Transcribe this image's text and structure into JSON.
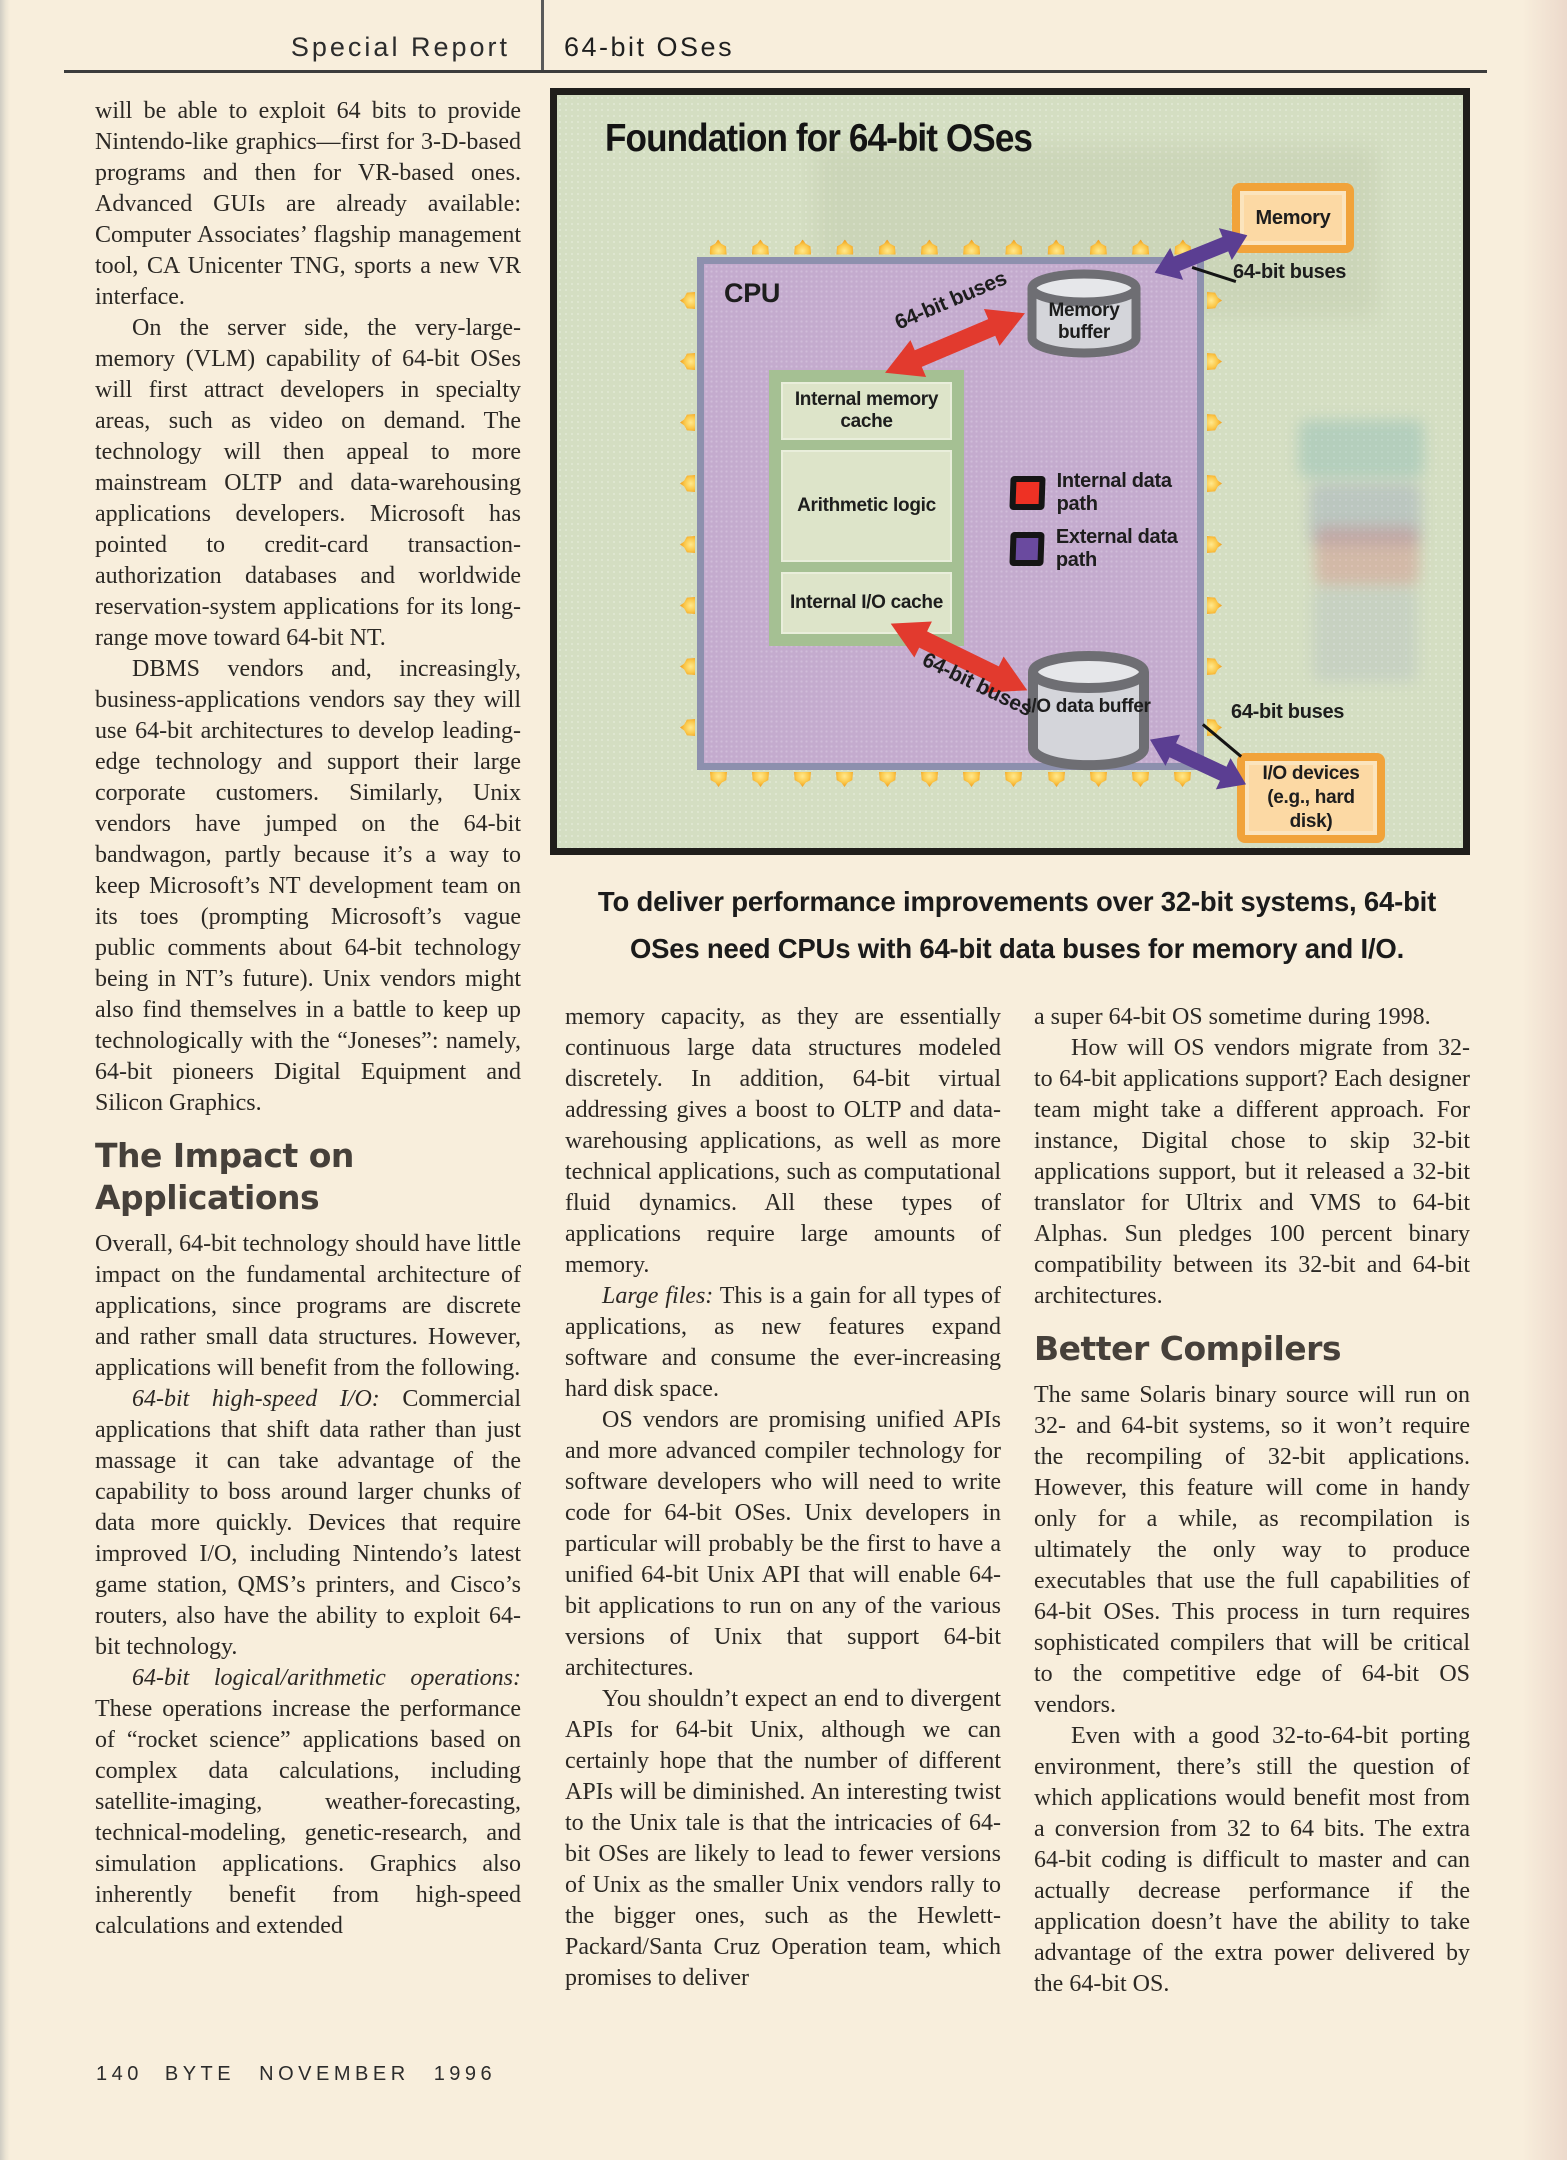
{
  "header": {
    "section": "Special Report",
    "topic": "64-bit OSes"
  },
  "footer": {
    "page_number": "140",
    "magazine_issue": "BYTE NOVEMBER 1996"
  },
  "figure": {
    "title": "Foundation for 64-bit OSes",
    "cpu_label": "CPU",
    "blocks": {
      "internal_memory_cache": "Internal memory cache",
      "arithmetic_logic": "Arithmetic logic",
      "internal_io_cache": "Internal I/O cache",
      "memory_buffer": "Memory buffer",
      "io_data_buffer": "I/O data buffer",
      "memory": "Memory",
      "io_devices": "I/O devices (e.g., hard disk)"
    },
    "bus_label": "64-bit buses",
    "legend": {
      "internal": "Internal data path",
      "external": "External data path"
    },
    "caption": "To deliver performance improvements over 32-bit systems, 64-bit OSes need CPUs with 64-bit data buses for memory and I/O.",
    "colors": {
      "internal_path": "#ee3124",
      "external_path": "#6a4a9f",
      "bus_red": "#e23a2e",
      "bus_purple": "#5b3e92",
      "diagram_bg": "#d4dec2",
      "cpu_fill": "#c4abce",
      "orange_border": "#f1a33a"
    }
  },
  "article": {
    "left": {
      "p1": "will be able to exploit 64 bits to provide Nintendo-like graphics—first for 3-D-based programs and then for VR-based ones. Advanced GUIs are already available: Computer Associates’ flagship management tool, CA Unicenter TNG, sports a new VR interface.",
      "p2": "On the server side, the very-large-memory (VLM) capability of 64-bit OSes will first attract developers in specialty areas, such as video on demand. The technology will then appeal to more mainstream OLTP and data-warehousing applications developers. Microsoft has pointed to credit-card transaction-authorization databases and worldwide reservation-system applications for its long-range move toward 64-bit NT.",
      "p3": "DBMS vendors and, increasingly, business-applications vendors say they will use 64-bit architectures to develop leading-edge technology and support their large corporate customers. Similarly, Unix vendors have jumped on the 64-bit bandwagon, partly because it’s a way to keep Microsoft’s NT development team on its toes (prompting Microsoft’s vague public comments about 64-bit technology being in NT’s future). Unix vendors might also find themselves in a battle to keep up technologically with the “Joneses”: namely, 64-bit pioneers Digital Equipment and Silicon Graphics.",
      "heading": "The Impact on Applications",
      "p4": "Overall, 64-bit technology should have little impact on the fundamental architecture of applications, since programs are discrete and rather small data structures. However, applications will benefit from the following.",
      "p5_lead": "64-bit high-speed I/O:",
      "p5_text": " Commercial applications that shift data rather than just massage it can take advantage of the capability to boss around larger chunks of data more quickly. Devices that require improved I/O, including Nintendo’s latest game station, QMS’s printers, and Cisco’s routers, also have the ability to exploit 64-bit technology.",
      "p6_lead": "64-bit logical/arithmetic operations:",
      "p6_text": " These operations increase the performance of “rocket science” applications based on complex data calculations, including satellite-imaging, weather-forecasting, technical-modeling, genetic-research, and simulation applications. Graphics also inherently benefit from high-speed calculations and extended"
    },
    "middle": {
      "p1": "memory capacity, as they are essentially continuous large data structures modeled discretely. In addition, 64-bit virtual addressing gives a boost to OLTP and data-warehousing applications, as well as more technical applications, such as computational fluid dynamics. All these types of applications require large amounts of memory.",
      "p2_lead": "Large files:",
      "p2_text": " This is a gain for all types of applications, as new features expand software and consume the ever-increasing hard disk space.",
      "p3": "OS vendors are promising unified APIs and more advanced compiler technology for software developers who will need to write code for 64-bit OSes. Unix developers in particular will probably be the first to have a unified 64-bit Unix API that will enable 64-bit applications to run on any of the various versions of Unix that support 64-bit architectures.",
      "p4": "You shouldn’t expect an end to divergent APIs for 64-bit Unix, although we can certainly hope that the number of different APIs will be diminished. An interesting twist to the Unix tale is that the intricacies of 64-bit OSes are likely to lead to fewer versions of Unix as the smaller Unix vendors rally to the bigger ones, such as the Hewlett-Packard/Santa Cruz Operation team, which promises to deliver"
    },
    "right": {
      "p1": "a super 64-bit OS sometime during 1998.",
      "p2": "How will OS vendors migrate from 32- to 64-bit applications support? Each designer team might take a different approach. For instance, Digital chose to skip 32-bit applications support, but it released a 32-bit translator for Ultrix and VMS to 64-bit Alphas. Sun pledges 100 percent binary compatibility between its 32-bit and 64-bit architectures.",
      "heading": "Better Compilers",
      "p3": "The same Solaris binary source will run on 32- and 64-bit systems, so it won’t require the recompiling of 32-bit applications. However, this feature will come in handy only for a while, as recompilation is ultimately the only way to produce executables that use the full capabilities of 64-bit OSes. This process in turn requires sophisticated compilers that will be critical to the competitive edge of 64-bit OS vendors.",
      "p4": "Even with a good 32-to-64-bit porting environment, there’s still the question of which applications would benefit most from a conversion from 32 to 64 bits. The extra 64-bit coding is difficult to master and can actually decrease performance if the application doesn’t have the ability to take advantage of the extra power delivered by the 64-bit OS."
    }
  }
}
